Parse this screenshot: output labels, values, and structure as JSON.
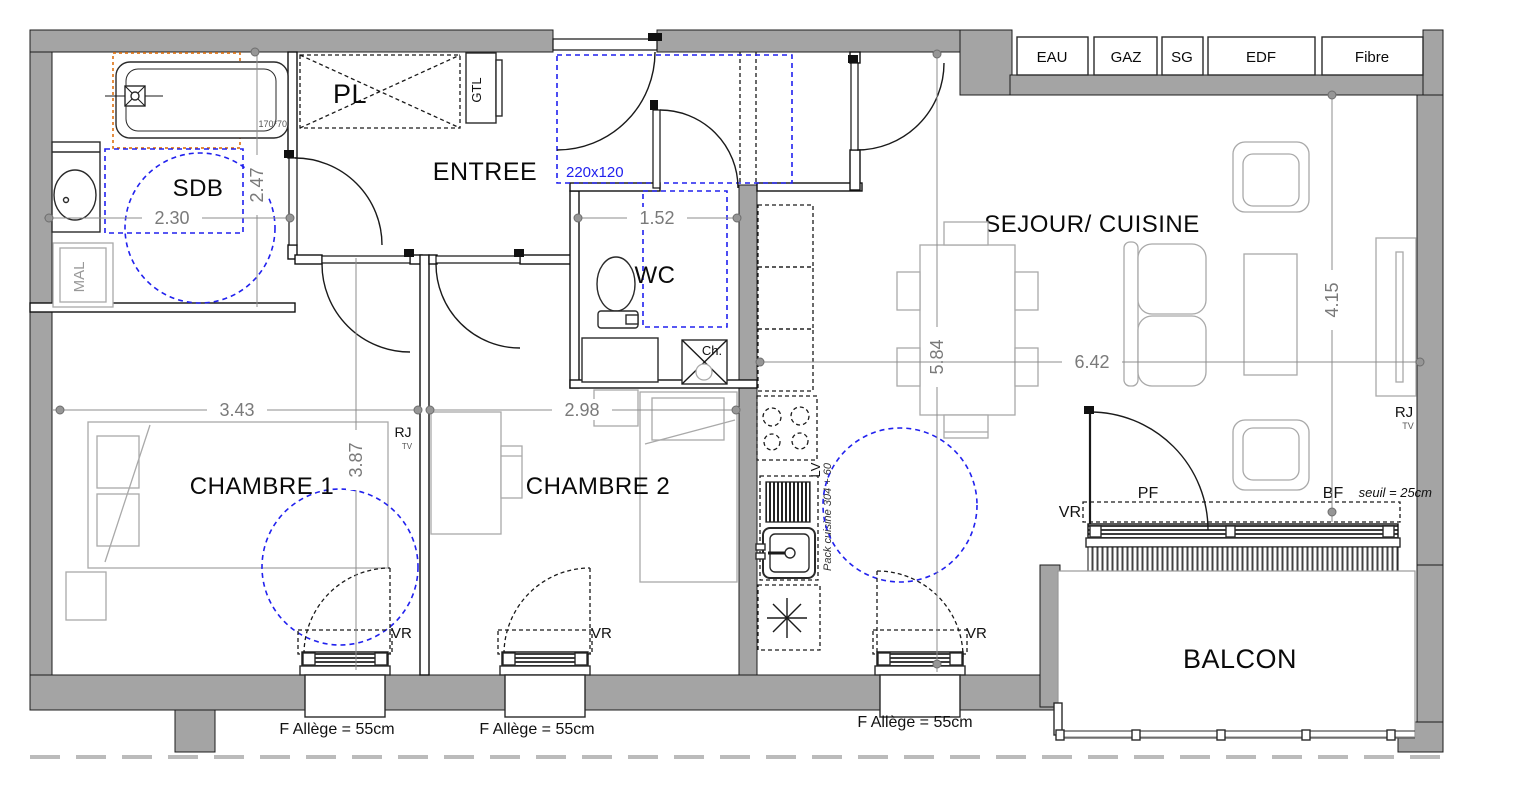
{
  "rooms": {
    "sdb": "SDB",
    "pl": "PL",
    "entree": "ENTREE",
    "wc": "WC",
    "sejour": "SEJOUR/ CUISINE",
    "chambre1": "CHAMBRE 1",
    "chambre2": "CHAMBRE 2",
    "balcon": "BALCON"
  },
  "utilities": [
    "EAU",
    "GAZ",
    "SG",
    "EDF",
    "Fibre"
  ],
  "dimensions": {
    "sdb_width": "2.30",
    "sdb_height": "2.47",
    "wc_width": "1.52",
    "entry_clearance": "220x120",
    "chambre1_width": "3.43",
    "chambre1_height": "3.87",
    "chambre2_width": "2.98",
    "sejour_height": "5.84",
    "sejour_width": "6.42",
    "sejour_depth": "4.15",
    "bathtub_size": "170*70"
  },
  "annotations": {
    "gtl": "GTL",
    "mal": "MAL",
    "lv": "LV",
    "chauffage": "Ch.",
    "rj": "RJ",
    "tv": "TV",
    "vr": "VR",
    "pf": "PF",
    "bf": "BF",
    "seuil": "seuil = 25cm",
    "window_sill": "F  Allège = 55cm",
    "pack_cuisine": "Pack cuisine 304 + 60"
  },
  "colors": {
    "wall": "#a4a4a4",
    "accessibility_circle": "#2121ee",
    "bath_highlight": "#e0791f",
    "dimension_text": "#7a7a7a",
    "furniture": "#a9a9a9"
  }
}
